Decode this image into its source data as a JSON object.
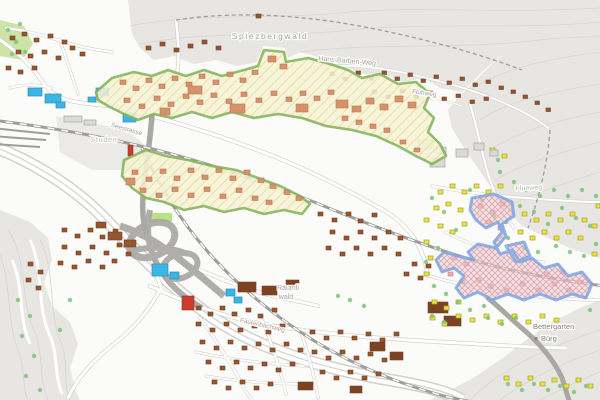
{
  "map": {
    "labels": {
      "forest": "Spiezbergwald",
      "path_top": "Hans-Barben-Weg",
      "path_fluhweg": "Fluhweg",
      "path_flueweg": "Flueweg",
      "area_studen": "Studen",
      "area_raeumli_line1": "Räumli",
      "area_raeumli_line2": "wald",
      "street_seestrasse": "Seestrasse",
      "street_faulenbachweg": "Faulenbachweg",
      "locality_bettergarten": "Bettergarten",
      "locality_buerg": "Bürg"
    },
    "colors": {
      "background": "#fbfbf9",
      "terrain_gray": "#e7e6e3",
      "terrain_light": "#eceae7",
      "contour": "#d8d6d2",
      "green_patch": "#cde4a6",
      "field_green": "#b9e284",
      "zone_green_border": "#7fb257",
      "zone_green_fill": "#f6f3d4",
      "zone_green_hatch": "#d9cf86",
      "zone_blue_border": "#7da4e4",
      "zone_blue_fill": "#efcdd2",
      "zone_blue_hatch": "#d895a0",
      "building_salmon": "#d6926b",
      "building_salmon_stroke": "#bd7a52",
      "building_brown": "#94562f",
      "building_brown_stroke": "#774424",
      "building_dark_brown": "#7c4322",
      "building_yellow": "#e8e242",
      "building_yellow_stroke": "#a9a326",
      "building_pink": "#e2aab2",
      "building_pink_stroke": "#c98995",
      "building_cyan": "#3db5e4",
      "building_cyan_stroke": "#2693bd",
      "building_gray": "#dadad8",
      "building_gray_stroke": "#a5a4a1",
      "building_red": "#cf3a30",
      "tree_green": "#7dc47a",
      "road_white": "#ffffff",
      "road_casing": "#d2d1cd",
      "road_gray": "#a9a8a4",
      "rail_gray": "#9e9d99",
      "label_gray": "#a3a29d",
      "label_faint": "#b7b6b2",
      "label_dark": "#85847f"
    }
  }
}
